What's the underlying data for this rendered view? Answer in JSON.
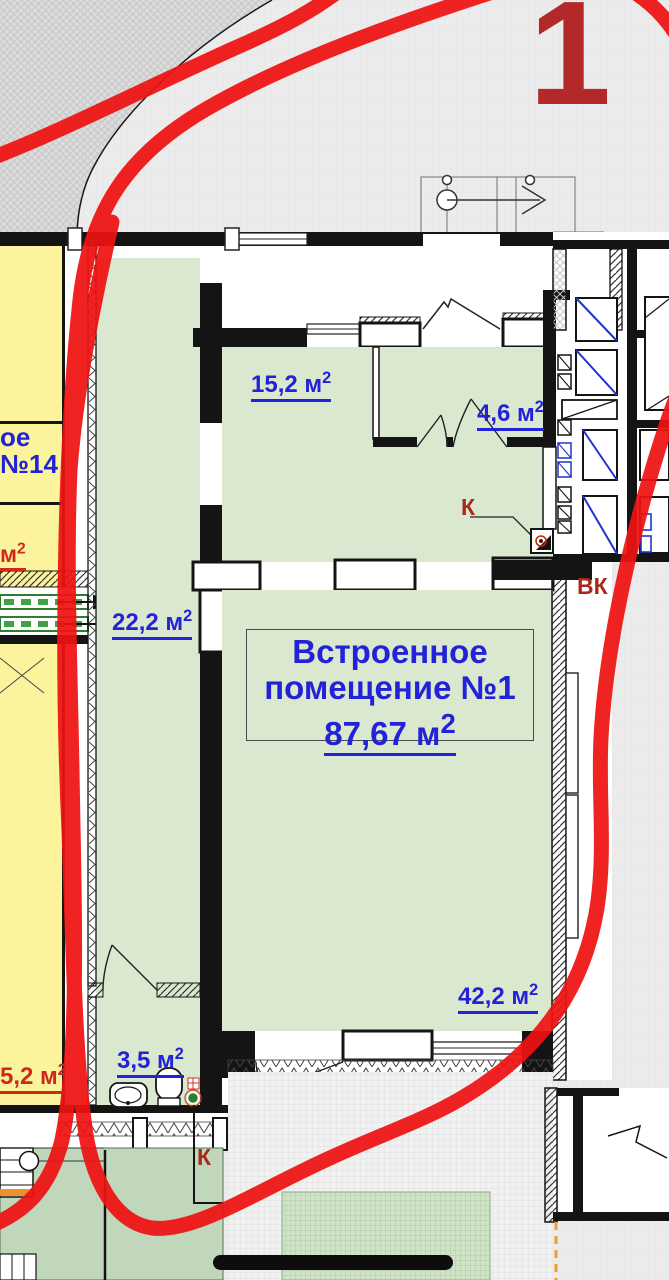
{
  "annotation_overlay": {
    "sheet_number": "1",
    "marker_color": "#ef1212",
    "sheet_number_color": "#b3292a"
  },
  "floor_plan": {
    "main_unit": {
      "title_line1": "Встроенное",
      "title_line2": "помещение №1",
      "area_value": "87,67 м",
      "area_sup": "2"
    },
    "rooms": {
      "room_15_2": {
        "area_value": "15,2 м",
        "area_sup": "2"
      },
      "room_4_6": {
        "area_value": "4,6 м",
        "area_sup": "2"
      },
      "corridor_22_2": {
        "area_value": "22,2 м",
        "area_sup": "2"
      },
      "hall_42_2": {
        "area_value": "42,2 м",
        "area_sup": "2"
      },
      "bathroom_3_5": {
        "area_value": "3,5 м",
        "area_sup": "2"
      },
      "left_room_5_2": {
        "area_value": "5,2 м",
        "area_sup": "2"
      },
      "apartment_14_line1": "ое",
      "apartment_14_line2": "№14",
      "left_cut_area_value": "м",
      "left_cut_area_sup": "2"
    },
    "utility_marks": {
      "sewer_riser_top": "К",
      "water_sewer": "ВК",
      "sewer_riser_bottom": "К"
    },
    "palette": {
      "room_fill_green": "#dae8d0",
      "room_fill_yellow": "#fbf49d",
      "lawn_green": "#c1d7bb",
      "paved_green": "#cfe3c7",
      "area_label_blue": "#2222d8",
      "area_label_red": "#d0281c",
      "utility_label_red": "#a8281e"
    }
  }
}
